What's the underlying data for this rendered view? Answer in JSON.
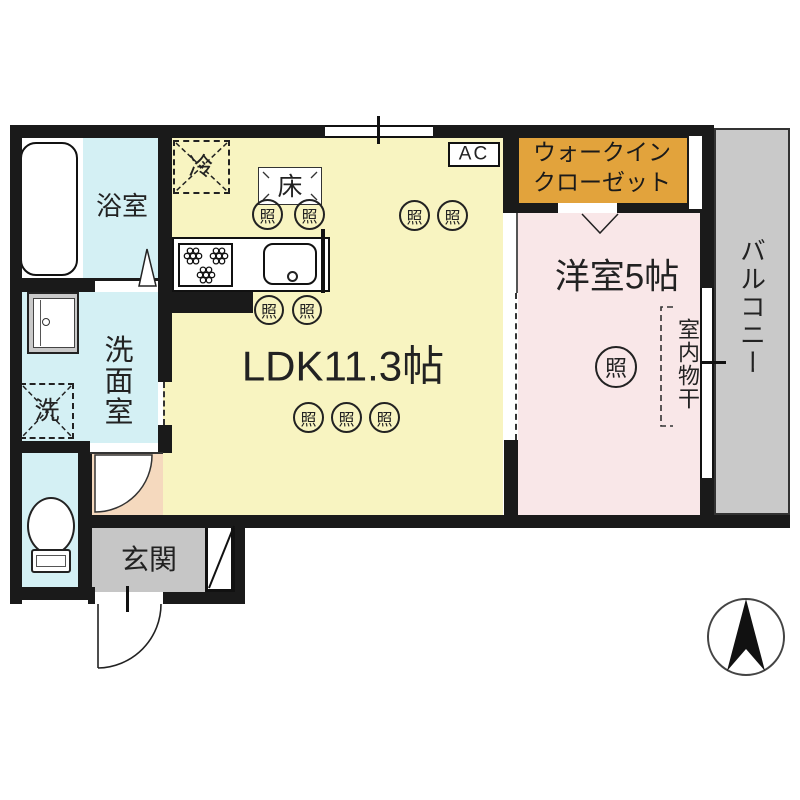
{
  "plan_title": "1LDK apartment floor plan",
  "rooms": {
    "bathroom": {
      "label": "浴室"
    },
    "washroom": {
      "label": "洗面室"
    },
    "ldk": {
      "label": "LDK11.3帖"
    },
    "western": {
      "label": "洋室5帖"
    },
    "closet": {
      "line1": "ウォークイン",
      "line2": "クローゼット"
    },
    "balcony": {
      "label": "バルコニー"
    },
    "entrance": {
      "label": "玄関"
    },
    "laundry": {
      "label": "室内物干"
    }
  },
  "fixtures": {
    "refrigerator": "冷",
    "washing_machine": "洗",
    "floor_hatch": "床",
    "air_conditioner": "AC",
    "light": "照"
  },
  "colors": {
    "ldk_floor": "#F8F4C1",
    "wet_area_floor": "#D4F0F4",
    "western_floor": "#F9E7E8",
    "closet_fill": "#E2A33C",
    "balcony_fill": "#C9C9C9",
    "entrance_fill": "#C6C6C6",
    "hall_fill": "#F5D9BE",
    "wall": "#1A1A1A"
  }
}
